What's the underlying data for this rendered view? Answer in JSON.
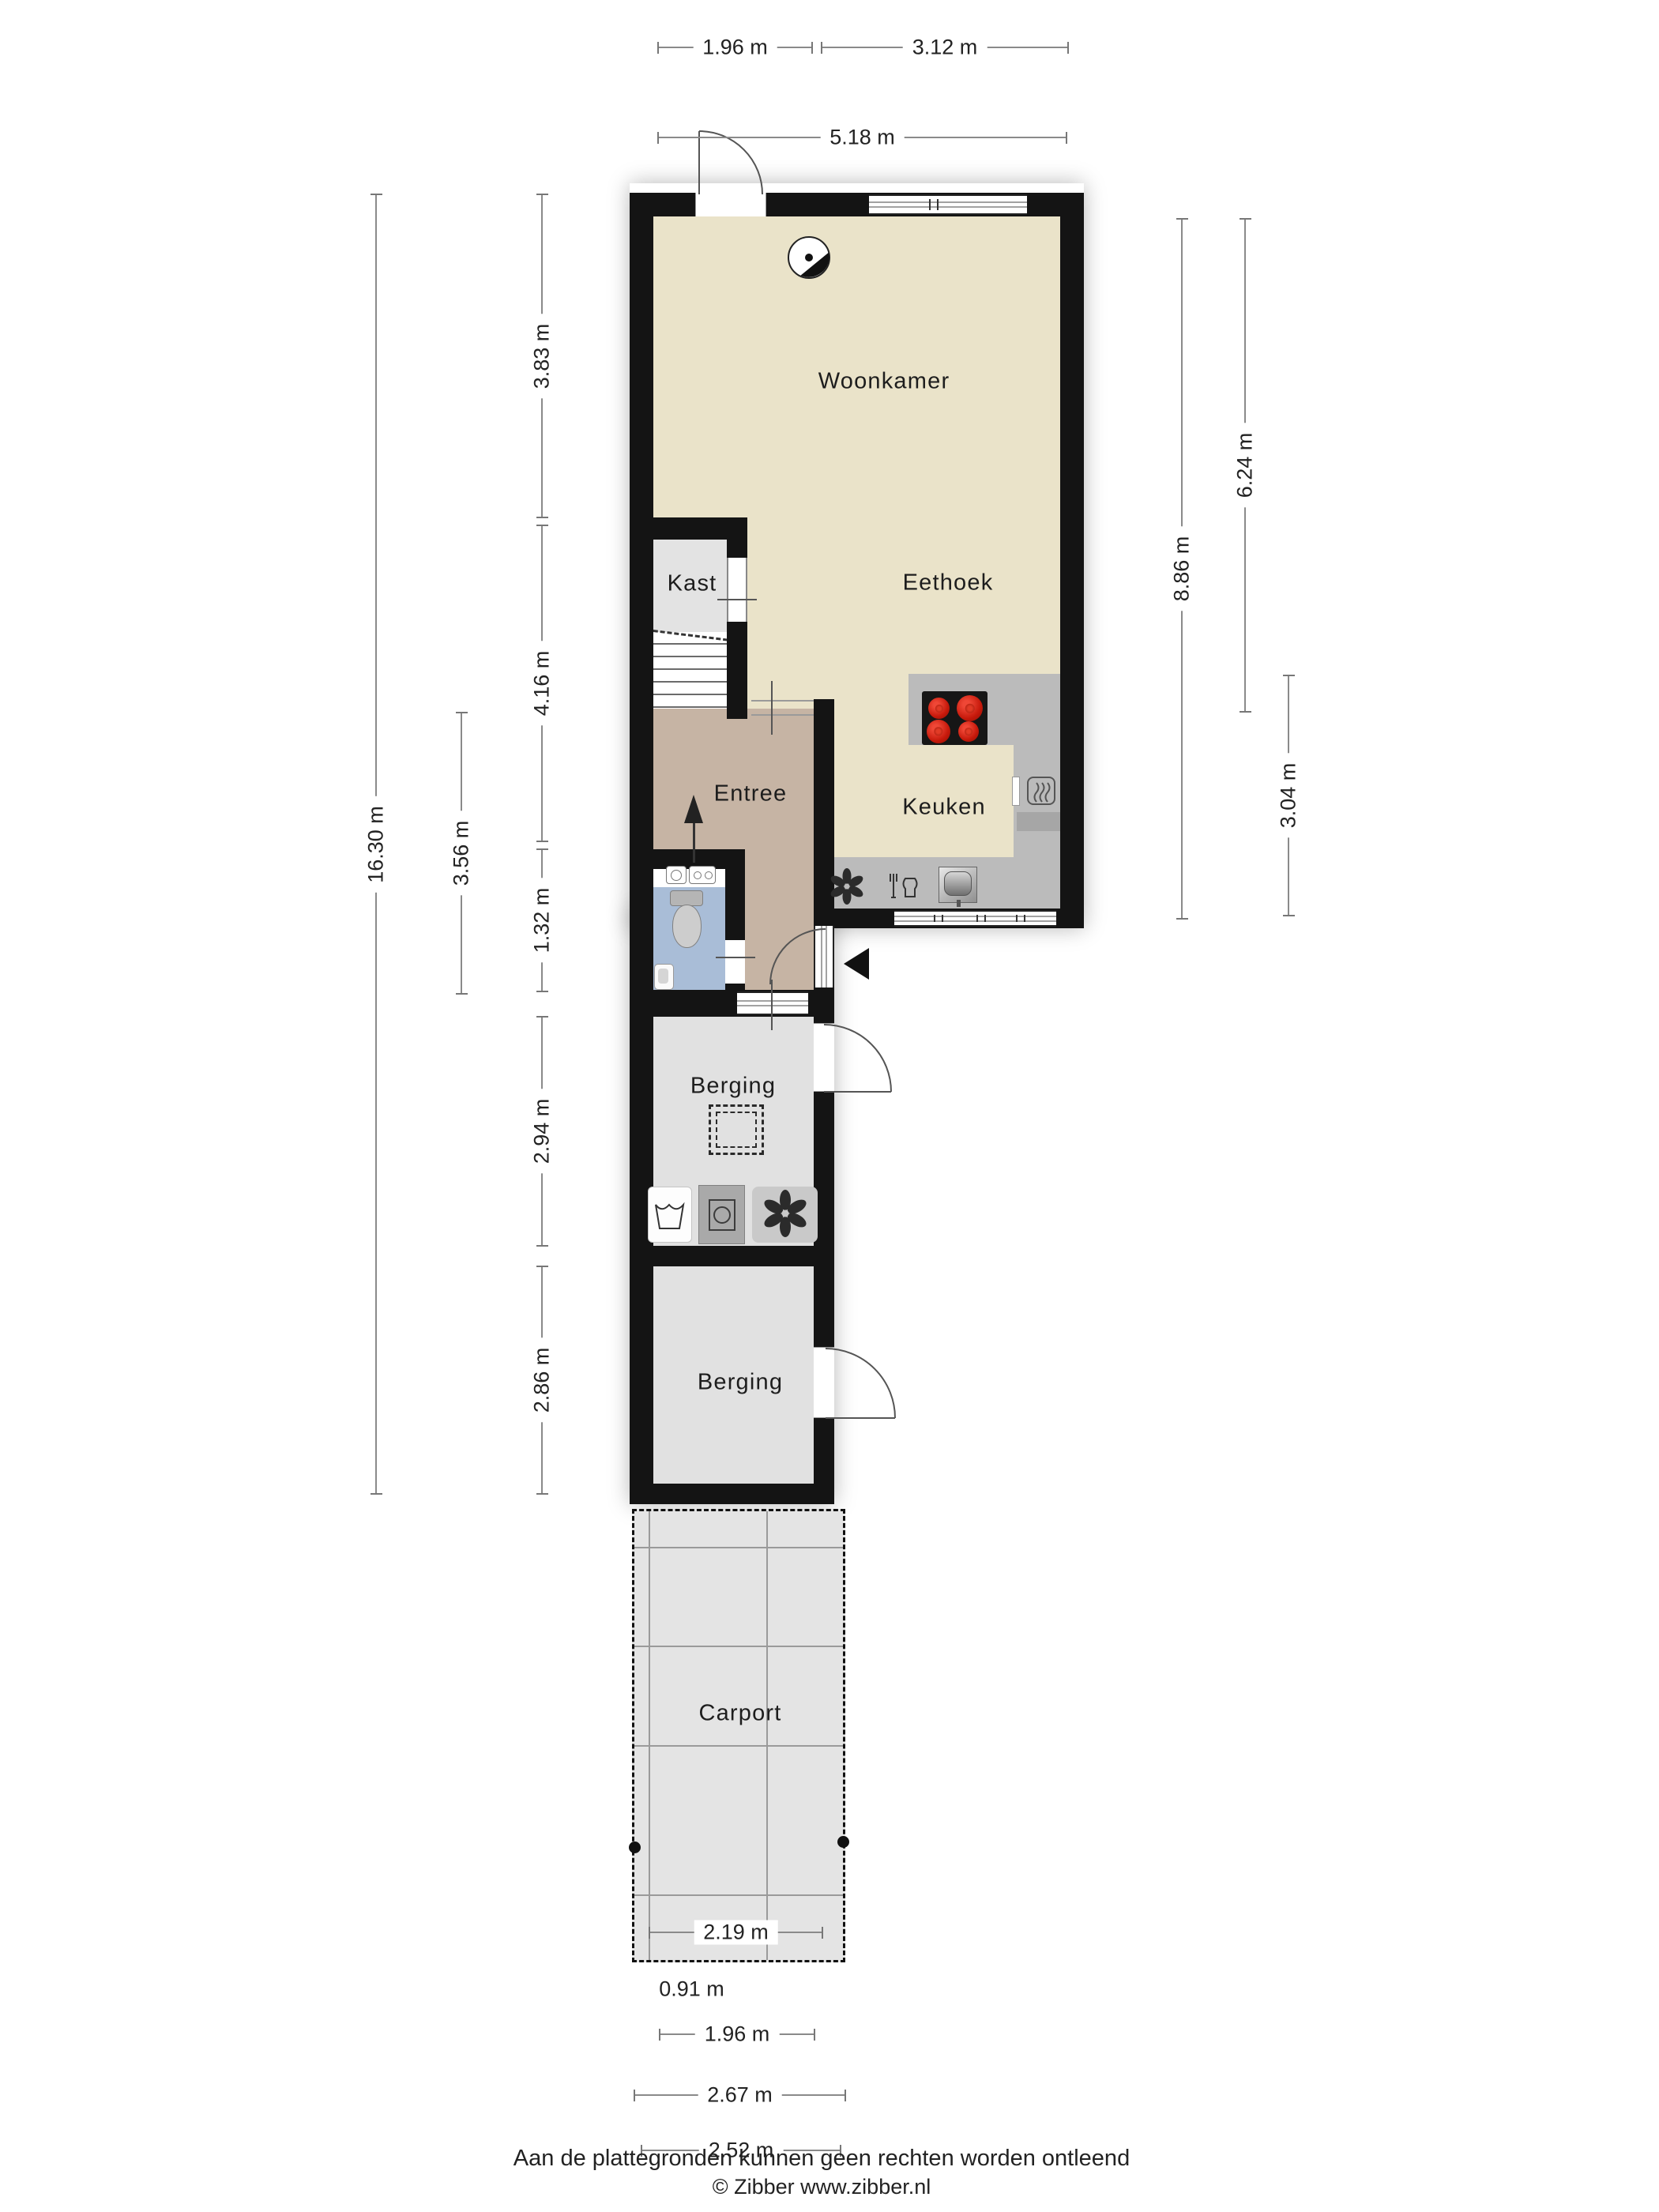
{
  "rooms": {
    "woonkamer": "Woonkamer",
    "eethoek": "Eethoek",
    "kast": "Kast",
    "entree": "Entree",
    "keuken": "Keuken",
    "berging1": "Berging",
    "berging2": "Berging",
    "carport": "Carport"
  },
  "dims": {
    "top_196": "1.96 m",
    "top_312": "3.12 m",
    "top_518": "5.18 m",
    "left_1630": "16.30 m",
    "left_356": "3.56 m",
    "left_383": "3.83 m",
    "left_416": "4.16 m",
    "left_132": "1.32 m",
    "left_294": "2.94 m",
    "left_286": "2.86 m",
    "right_886": "8.86 m",
    "right_624": "6.24 m",
    "right_304": "3.04 m",
    "bottom_219": "2.19 m",
    "bottom_091": "0.91 m",
    "bottom_196": "1.96 m",
    "bottom_267": "2.67 m",
    "bottom_252": "2.52 m"
  },
  "footer": {
    "line1": "Aan de plattegronden kunnen geen rechten worden ontleend",
    "line2": "© Zibber www.zibber.nl"
  },
  "colors": {
    "wall": "#141414",
    "living_floor": "#EAE3C9",
    "entree_floor": "#C6B4A4",
    "toilet_floor": "#A9BDD7",
    "storage_floor": "#E2E2E2",
    "counter": "#BBBBBB",
    "carport": "#E4E4E4",
    "burner_red": "#D23B2A",
    "dim_line": "#8A8A8A",
    "text": "#222222"
  },
  "icons": {
    "ceiling_light": "circle-with-segment",
    "cooktop": "4-red-burners",
    "oven": "rounded-square-heat-waves",
    "extractor_fan": "6-petal-asterisk",
    "dishwasher": "fork-and-jug",
    "sink": "metallic-basin",
    "toilet": "tank-and-bowl",
    "hand_basin": "small-corner-sink",
    "laundry_sink": "wavy-basin",
    "washing_machine": "square-with-drum",
    "vent_fan": "6-petal-asterisk",
    "stairs_arrow": "up-arrow",
    "entrance_arrow": "left-black-triangle",
    "floor_hatch": "double-dashed-square"
  }
}
